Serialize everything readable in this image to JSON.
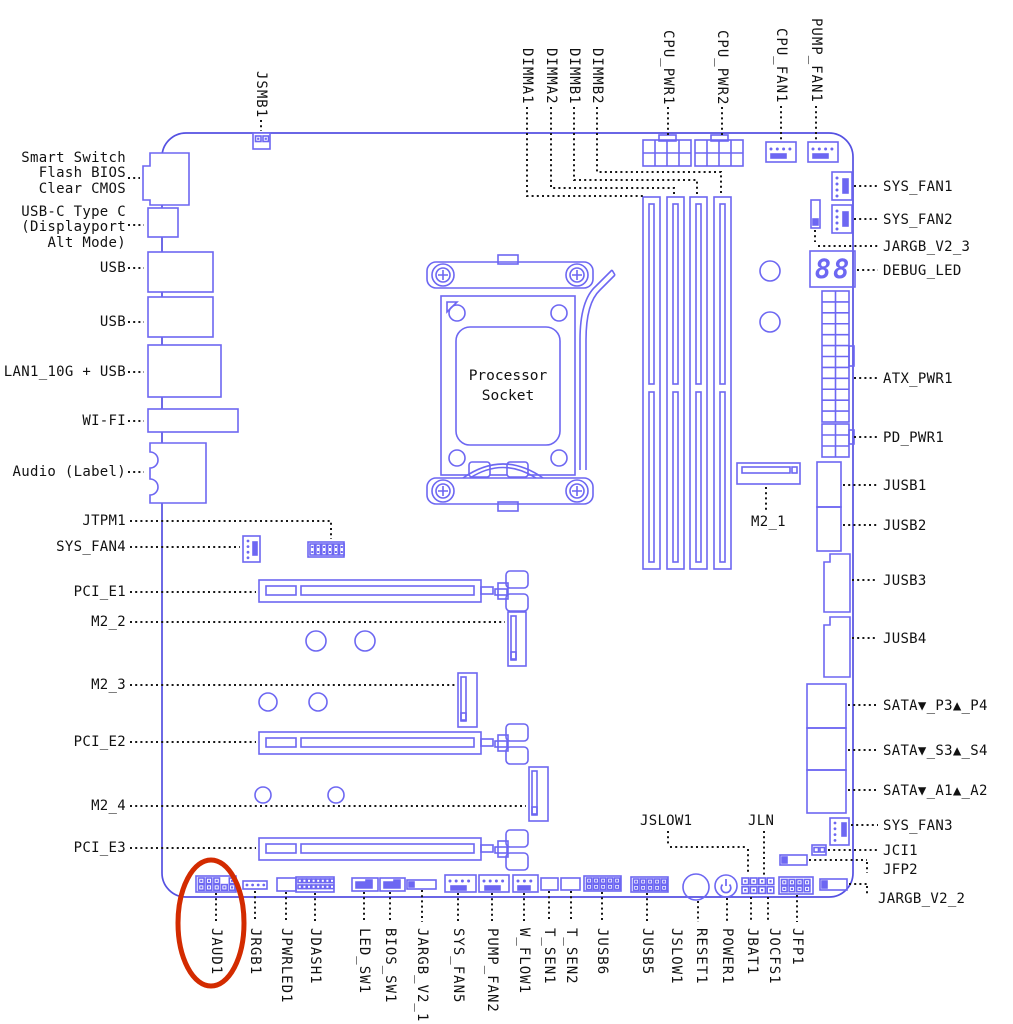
{
  "colors": {
    "board_line": "#5551e2",
    "connector_line": "#6d67f2",
    "leader": "#171717",
    "highlight": "#d32b00",
    "led_text": "#5551e2"
  },
  "socket": {
    "line1": "Processor",
    "line2": "Socket"
  },
  "debug_led": {
    "value": "88"
  },
  "labels_top": [
    {
      "text": "JSMB1",
      "x": 261,
      "bottom": 118
    },
    {
      "text": "DIMMA1",
      "x": 527,
      "bottom": 105
    },
    {
      "text": "DIMMA2",
      "x": 551,
      "bottom": 105
    },
    {
      "text": "DIMMB1",
      "x": 574,
      "bottom": 105
    },
    {
      "text": "DIMMB2",
      "x": 597,
      "bottom": 105
    },
    {
      "text": "CPU_PWR1",
      "x": 668,
      "bottom": 105
    },
    {
      "text": "CPU_PWR2",
      "x": 722,
      "bottom": 105
    },
    {
      "text": "CPU_FAN1",
      "x": 781,
      "bottom": 103
    },
    {
      "text": "PUMP_FAN1",
      "x": 816,
      "bottom": 103
    }
  ],
  "labels_left": [
    {
      "lines": [
        "Smart Switch",
        "Flash BIOS",
        "Clear CMOS"
      ],
      "top": 151
    },
    {
      "lines": [
        "USB-C Type C",
        "(Displayport",
        "Alt Mode)"
      ],
      "top": 205
    },
    {
      "lines": [
        "USB"
      ],
      "top": 261
    },
    {
      "lines": [
        "USB"
      ],
      "top": 315
    },
    {
      "lines": [
        "LAN1_10G + USB"
      ],
      "top": 365
    },
    {
      "lines": [
        "WI-FI"
      ],
      "top": 414
    },
    {
      "lines": [
        "Audio (Label)"
      ],
      "top": 465
    },
    {
      "lines": [
        "JTPM1"
      ],
      "top": 514
    },
    {
      "lines": [
        "SYS_FAN4"
      ],
      "top": 540
    },
    {
      "lines": [
        "PCI_E1"
      ],
      "top": 585
    },
    {
      "lines": [
        "M2_2"
      ],
      "top": 615
    },
    {
      "lines": [
        "M2_3"
      ],
      "top": 678
    },
    {
      "lines": [
        "PCI_E2"
      ],
      "top": 735
    },
    {
      "lines": [
        "M2_4"
      ],
      "top": 799
    },
    {
      "lines": [
        "PCI_E3"
      ],
      "top": 841
    }
  ],
  "labels_right": [
    {
      "text": "SYS_FAN1",
      "top": 179
    },
    {
      "text": "SYS_FAN2",
      "top": 212
    },
    {
      "text": "JARGB_V2_3",
      "top": 239
    },
    {
      "text": "DEBUG_LED",
      "top": 263
    },
    {
      "text": "ATX_PWR1",
      "top": 371
    },
    {
      "text": "PD_PWR1",
      "top": 430
    },
    {
      "text": "JUSB1",
      "top": 478
    },
    {
      "text": "JUSB2",
      "top": 518
    },
    {
      "text": "JUSB3",
      "top": 573
    },
    {
      "text": "JUSB4",
      "top": 631
    },
    {
      "text": "SATA▼_P3▲_P4",
      "top": 698
    },
    {
      "text": "SATA▼_S3▲_S4",
      "top": 743
    },
    {
      "text": "SATA▼_A1▲_A2",
      "top": 783
    },
    {
      "text": "SYS_FAN3",
      "top": 818
    },
    {
      "text": "JCI1",
      "top": 843
    },
    {
      "text": "JFP2",
      "top": 862
    },
    {
      "text": "JARGB_V2_2",
      "top": 891,
      "left": 878
    }
  ],
  "labels_bottom": [
    {
      "text": "JAUD1",
      "x": 216
    },
    {
      "text": "JRGB1",
      "x": 255
    },
    {
      "text": "JPWRLED1",
      "x": 286
    },
    {
      "text": "JDASH1",
      "x": 315
    },
    {
      "text": "LED_SW1",
      "x": 364
    },
    {
      "text": "BIOS_SW1",
      "x": 390
    },
    {
      "text": "JARGB_V2_1",
      "x": 422
    },
    {
      "text": "SYS_FAN5",
      "x": 458
    },
    {
      "text": "PUMP_FAN2",
      "x": 492
    },
    {
      "text": "W_FLOW1",
      "x": 524
    },
    {
      "text": "T_SEN1",
      "x": 549
    },
    {
      "text": "T_SEN2",
      "x": 571
    },
    {
      "text": "JUSB6",
      "x": 602
    },
    {
      "text": "JUSB5",
      "x": 647
    },
    {
      "text": "JSLOW1",
      "x": 676
    },
    {
      "text": "RESET1",
      "x": 701
    },
    {
      "text": "POWER1",
      "x": 727
    },
    {
      "text": "JBAT1",
      "x": 752
    },
    {
      "text": "JOCFS1",
      "x": 774
    },
    {
      "text": "JFP1",
      "x": 797
    }
  ],
  "labels_inner": [
    {
      "text": "JSLOW1",
      "x": 640,
      "y": 813
    },
    {
      "text": "JLN",
      "x": 748,
      "y": 813
    },
    {
      "text": "M2_1",
      "x": 751,
      "y": 514
    }
  ]
}
